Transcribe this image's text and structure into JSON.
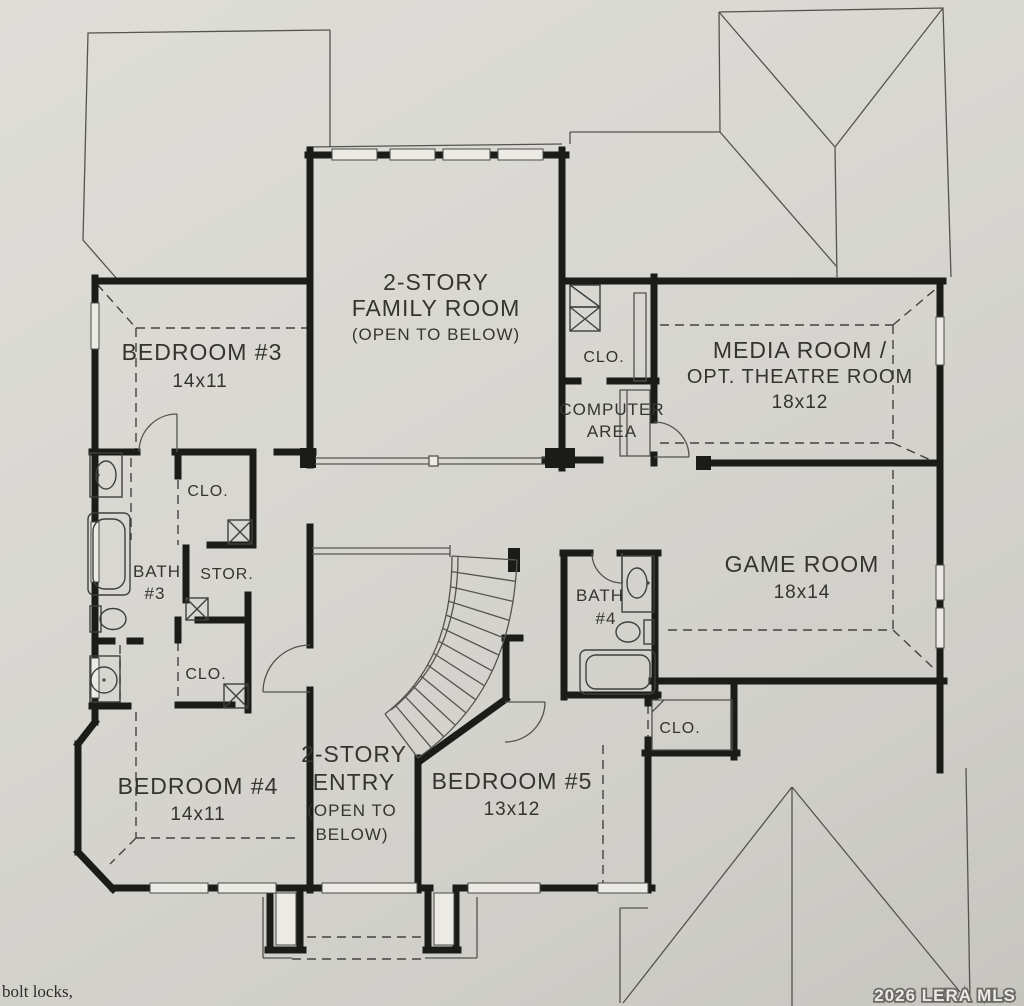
{
  "plan_title": "Second floor residential floor plan",
  "rooms": {
    "family": {
      "line1": "2-STORY",
      "line2": "FAMILY ROOM",
      "line3": "(OPEN TO BELOW)"
    },
    "bedroom3": {
      "name": "BEDROOM #3",
      "dims": "14x11"
    },
    "media": {
      "line1": "MEDIA ROOM /",
      "line2": "OPT. THEATRE ROOM",
      "dims": "18x12"
    },
    "game": {
      "name": "GAME ROOM",
      "dims": "18x14"
    },
    "computer": {
      "line1": "COMPUTER",
      "line2": "AREA"
    },
    "bath3": {
      "line1": "BATH",
      "line2": "#3"
    },
    "bath4": {
      "line1": "BATH",
      "line2": "#4"
    },
    "storage": {
      "name": "STOR."
    },
    "closet_hall": {
      "name": "CLO."
    },
    "closet_upper_left": {
      "name": "CLO."
    },
    "closet_lower_left": {
      "name": "CLO."
    },
    "closet_bath4": {
      "name": "CLO."
    },
    "bedroom4": {
      "name": "BEDROOM #4",
      "dims": "14x11"
    },
    "entry": {
      "line1": "2-STORY",
      "line2": "ENTRY",
      "line3": "(OPEN TO",
      "line4": "BELOW)"
    },
    "bedroom5": {
      "name": "BEDROOM #5",
      "dims": "13x12"
    }
  },
  "caption_left": "bolt locks,",
  "watermark": "2026 LERA MLS",
  "colors": {
    "paper": "#d8d7d2",
    "wall": "#1b1b19",
    "thin_line": "#55534e",
    "text": "#35342f",
    "watermark_fill": "#eae9e5",
    "watermark_stroke": "#6b6964"
  }
}
